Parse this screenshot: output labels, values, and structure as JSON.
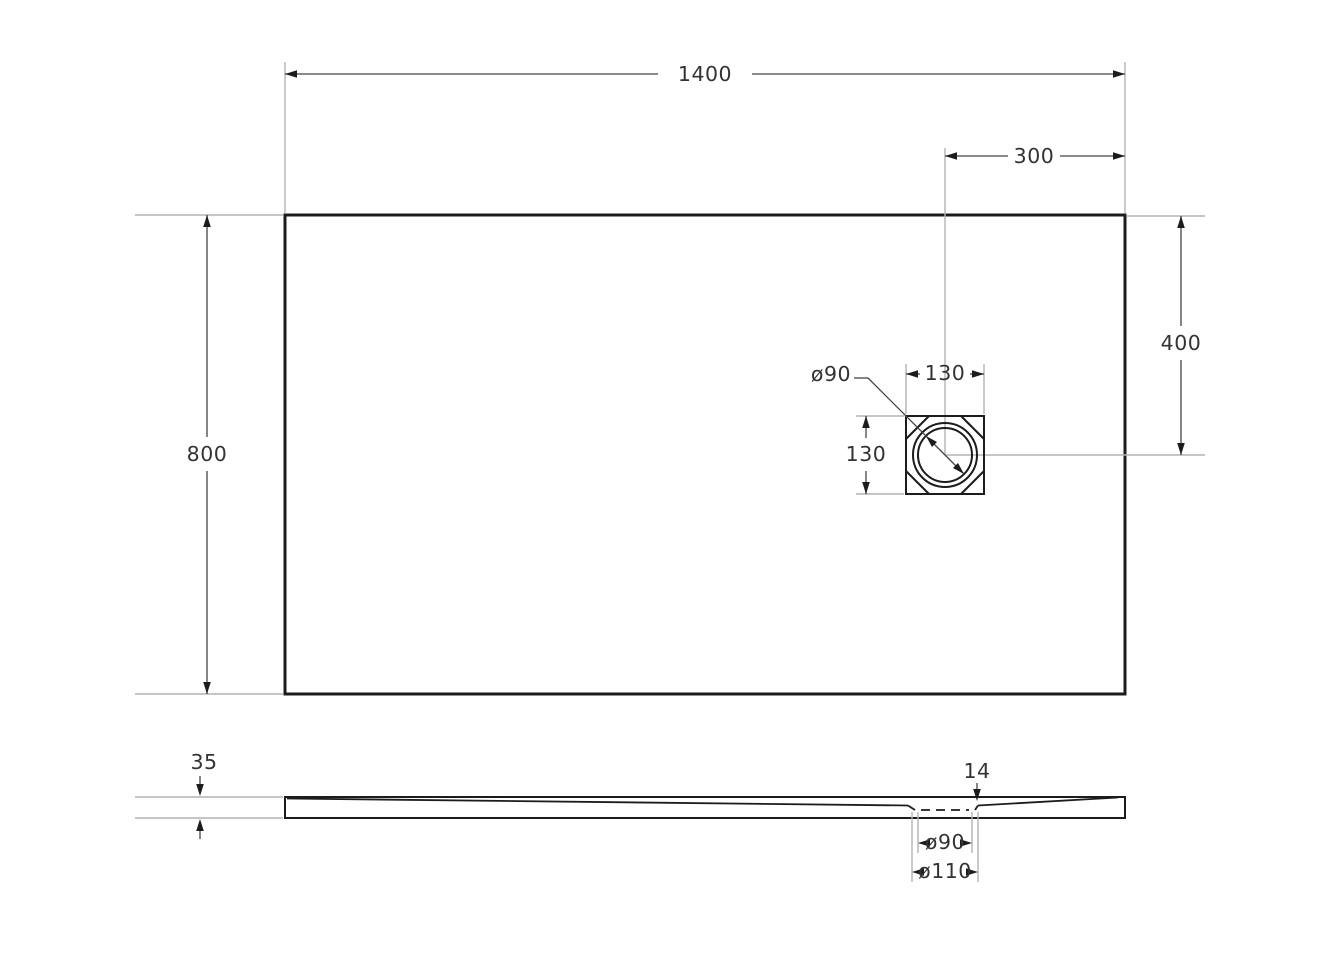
{
  "drawing": {
    "views": {
      "top": {
        "dims": {
          "overall_width": "1400",
          "overall_depth": "800",
          "drain_offset_from_right": "300",
          "drain_offset_from_top": "400",
          "drain_box_width": "130",
          "drain_box_height": "130",
          "drain_diameter": "ø90"
        }
      },
      "side": {
        "dims": {
          "edge_thickness": "35",
          "drain_depth": "14",
          "drain_hole_diameter": "ø90",
          "drain_recess_diameter": "ø110"
        }
      }
    },
    "colors": {
      "background": "#ffffff",
      "outline": "#1c1c1c",
      "dimension_line": "#444444",
      "extension_line": "#b4b4b4",
      "text": "#333333"
    }
  }
}
